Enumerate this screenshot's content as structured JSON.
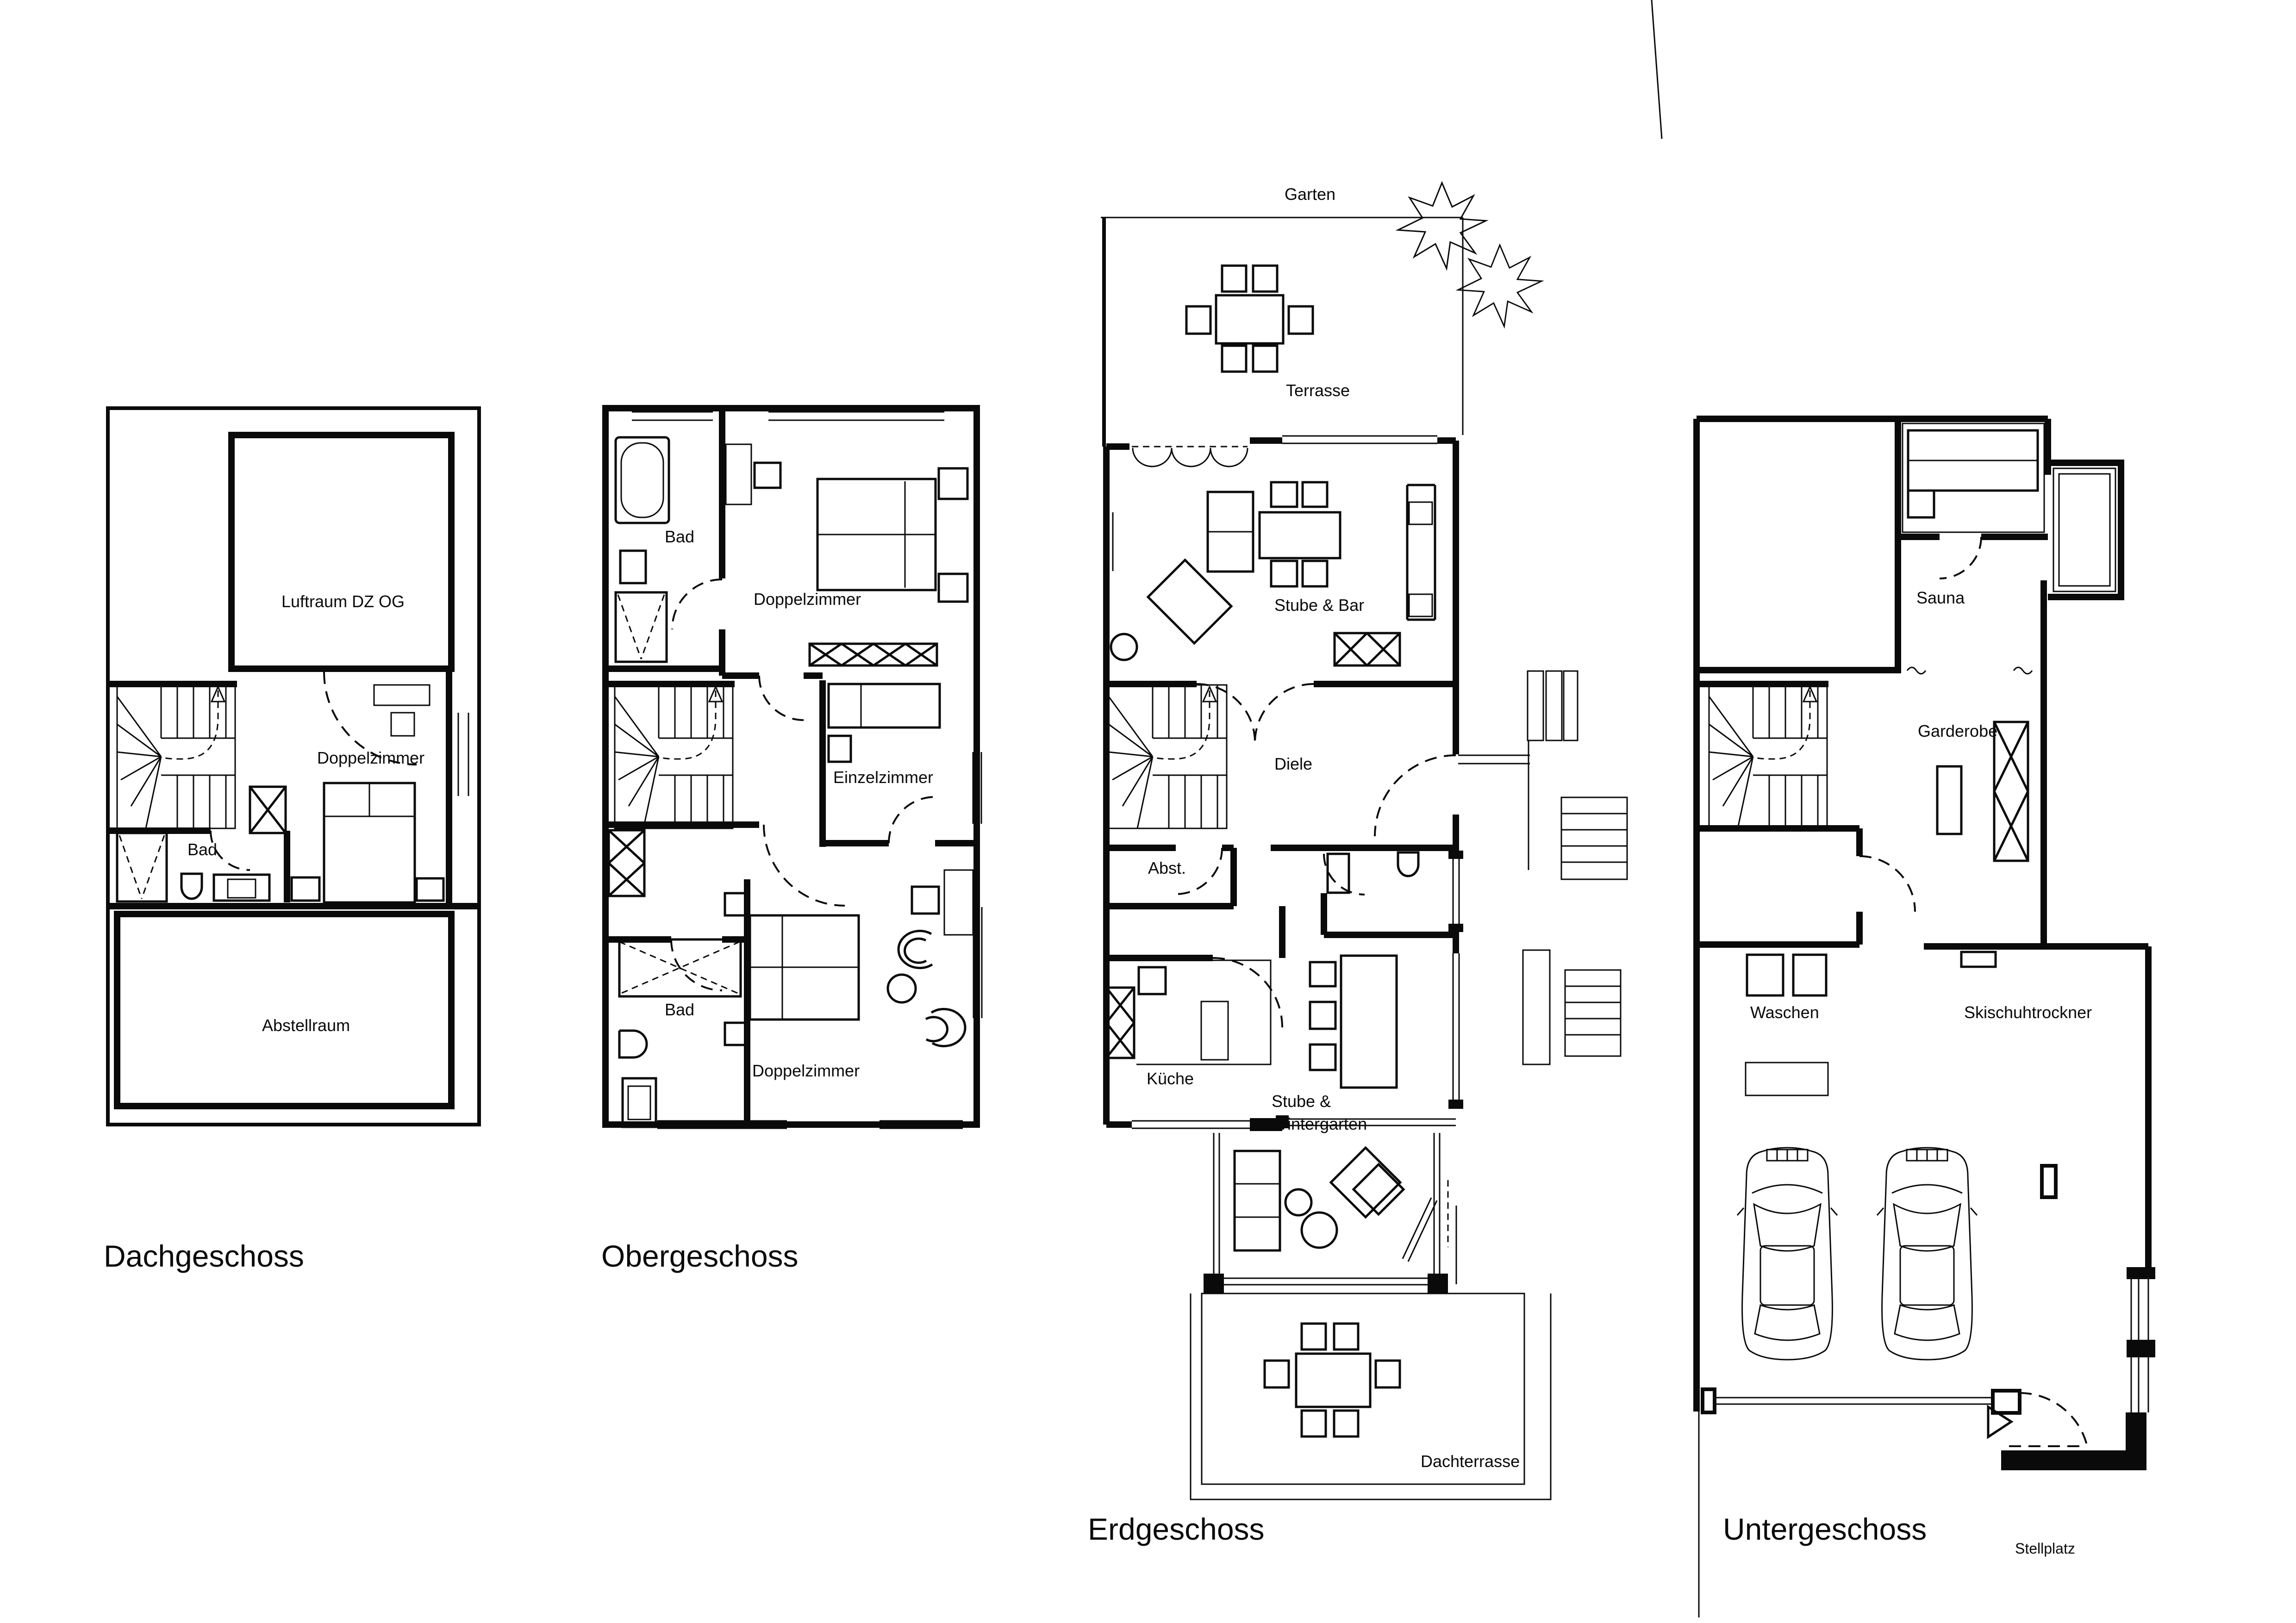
{
  "document": {
    "kind": "architectural-floor-plan-sheet",
    "ink_color": "#0a0a0a",
    "paper_color": "#ffffff"
  },
  "floors": [
    {
      "id": "dachgeschoss",
      "title": "Dachgeschoss",
      "rooms": [
        {
          "label": "Luftraum DZ OG"
        },
        {
          "label": "Doppelzimmer"
        },
        {
          "label": "Bad"
        },
        {
          "label": "Abstellraum"
        }
      ]
    },
    {
      "id": "obergeschoss",
      "title": "Obergeschoss",
      "rooms": [
        {
          "label": "Bad"
        },
        {
          "label": "Doppelzimmer"
        },
        {
          "label": "Einzelzimmer"
        },
        {
          "label": "Bad"
        },
        {
          "label": "Doppelzimmer"
        }
      ]
    },
    {
      "id": "erdgeschoss",
      "title": "Erdgeschoss",
      "rooms": [
        {
          "label": "Garten"
        },
        {
          "label": "Terrasse"
        },
        {
          "label": "Stube & Bar"
        },
        {
          "label": "Diele"
        },
        {
          "label": "Abst."
        },
        {
          "label": "Küche"
        },
        {
          "label": "Stube &"
        },
        {
          "label": "Wintergarten"
        },
        {
          "label": "Dachterrasse"
        }
      ]
    },
    {
      "id": "untergeschoss",
      "title": "Untergeschoss",
      "rooms": [
        {
          "label": "Sauna"
        },
        {
          "label": "Garderobe"
        },
        {
          "label": "Waschen"
        },
        {
          "label": "Skischuhtrockner"
        },
        {
          "label": "Stellplatz"
        }
      ]
    }
  ]
}
